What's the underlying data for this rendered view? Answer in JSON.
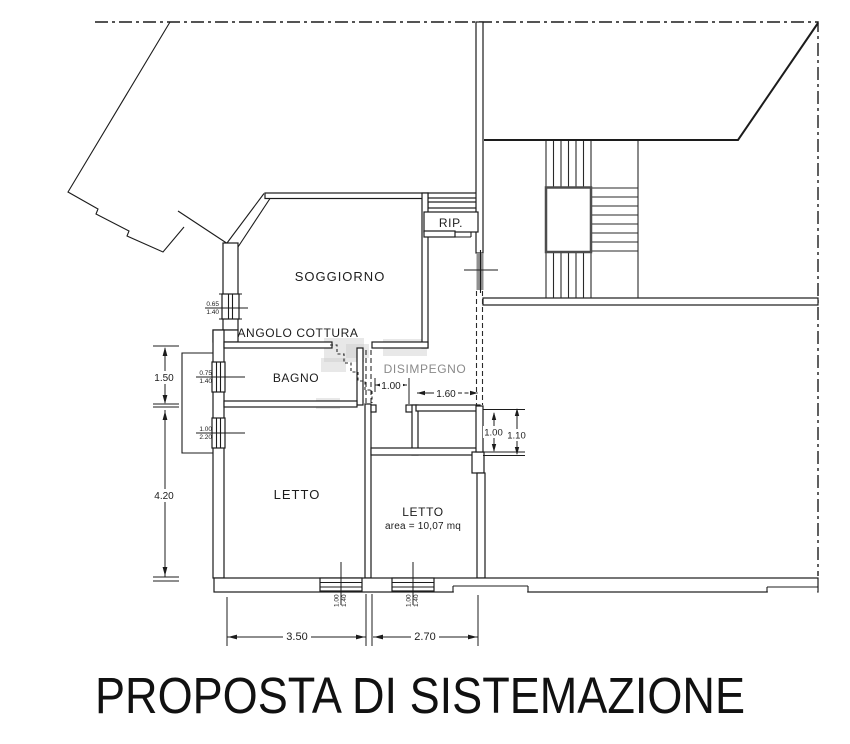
{
  "title": "PROPOSTA DI SISTEMAZIONE",
  "rooms": {
    "soggiorno": {
      "label": "SOGGIORNO"
    },
    "angolo_cottura": {
      "label": "ANGOLO COTTURA"
    },
    "bagno": {
      "label": "BAGNO"
    },
    "disimpegno": {
      "label": "DISIMPEGNO"
    },
    "letto_grande": {
      "label": "LETTO"
    },
    "letto_piccolo": {
      "label": "LETTO",
      "area": "area = 10,07 mq"
    },
    "ripostiglio": {
      "label": "RIP."
    }
  },
  "dimensions": {
    "left_upper": "1.50",
    "left_lower": "4.20",
    "bottom_left": "3.50",
    "bottom_right": "2.70",
    "hall_width": "1.00",
    "passage_width": "1.60",
    "stair_opening_inner": "1.00",
    "stair_opening_outer": "1.10",
    "window_living": {
      "w": "0.65",
      "h": "1.40"
    },
    "window_bath": {
      "w": "0.75",
      "h": "1.40"
    },
    "door_bedroom": {
      "w": "1.00",
      "h": "2.20"
    },
    "window_bed_left": {
      "w": "1.00",
      "h": "1.40"
    },
    "window_bed_right": {
      "w": "1.00",
      "h": "1.40"
    }
  },
  "colors": {
    "line": "#1c1c1c",
    "muted_text": "#8a8a8a",
    "stair_accent": "#4d4d4d",
    "door_fill": "#8f8f8f",
    "watermark": "#c9c9c9"
  }
}
